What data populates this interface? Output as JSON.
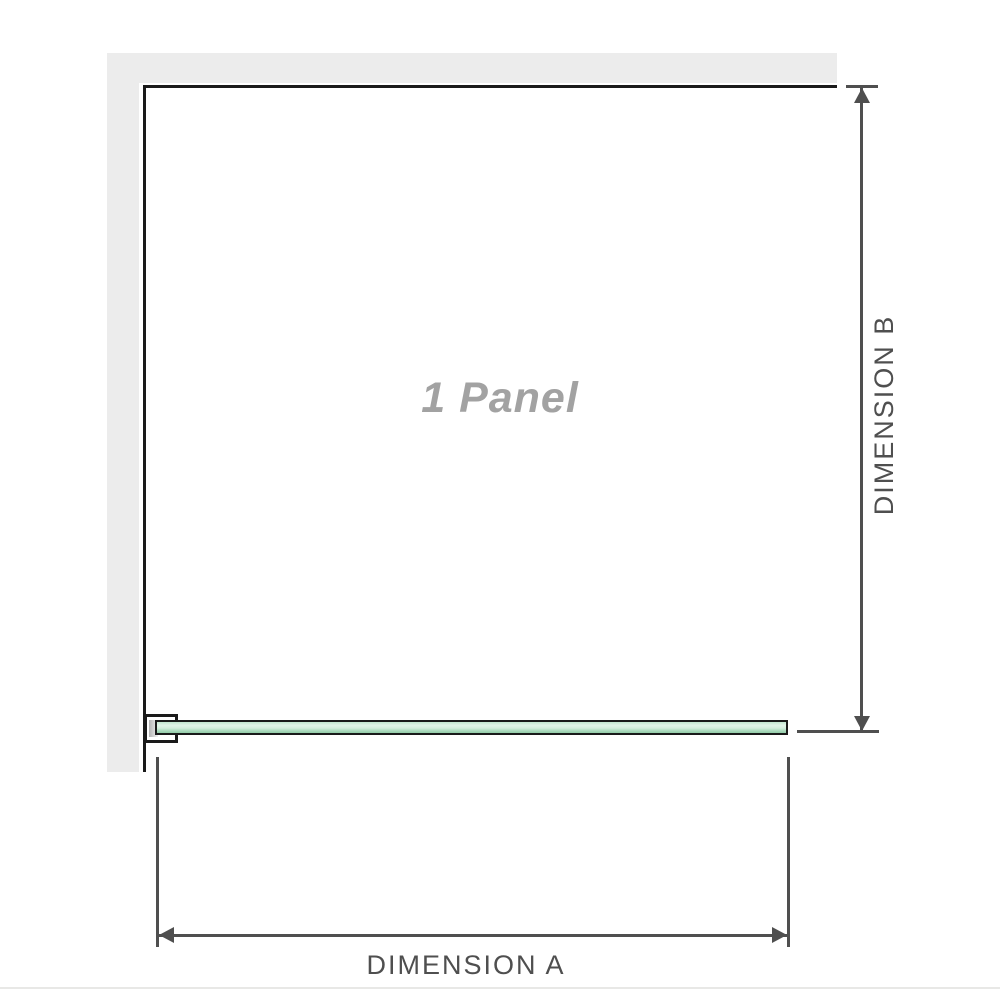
{
  "labels": {
    "panel": "1 Panel",
    "dimension_a": "DIMENSION A",
    "dimension_b": "DIMENSION B"
  },
  "colors": {
    "wall_gray": "#ececec",
    "outline_black": "#1a1a1a",
    "dimension_line_gray": "#4f4f4f",
    "glass_green_light": "#e2f4e8",
    "glass_green_dark": "#93cca8",
    "panel_label_gray": "#a2a2a2",
    "divider_gray": "#e8e8e6"
  }
}
